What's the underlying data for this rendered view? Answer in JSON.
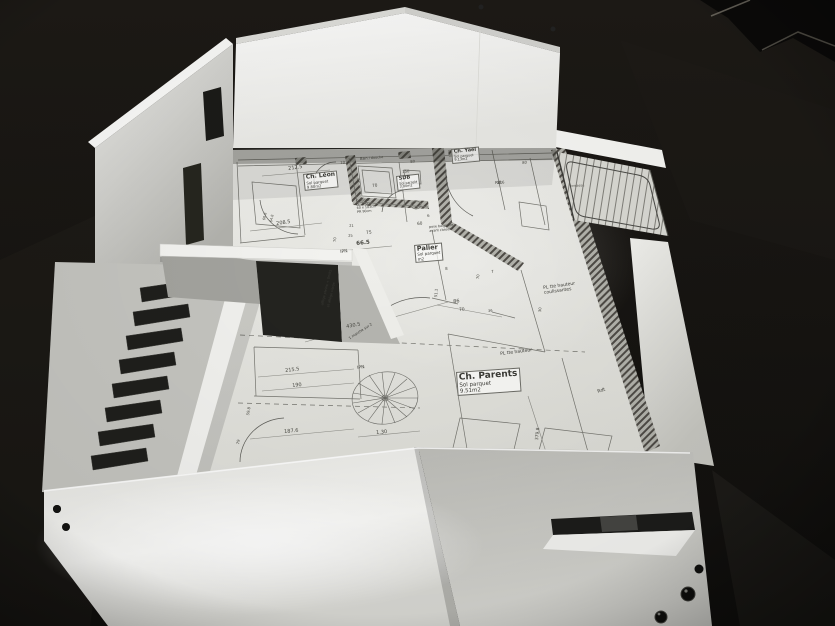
{
  "colors": {
    "table_background": "#16130f",
    "foam_white": "#f4f4f1",
    "plan_paper": "#ececе8",
    "drawing_ink": "#3a3a35",
    "hatch_wall": "#4e4b46",
    "shadow": "#23231f"
  },
  "plan": {
    "rooms": [
      {
        "name": "Ch. Léon",
        "floor": "Sol parquet",
        "area": "9.80m2"
      },
      {
        "name": "SDB",
        "floor": "Sol carrelé",
        "area": "3.80m2"
      },
      {
        "name": "Ch. Yael",
        "floor": "Sol parquet",
        "area": "9.13m2"
      },
      {
        "name": "Palier",
        "floor": "Sol parquet",
        "area": "m2"
      },
      {
        "name": "Ch. Parents",
        "floor": "Sol parquet",
        "area": "9.51m2"
      }
    ],
    "notes": {
      "bain": "Bain / douche",
      "colonne1": "Colonne",
      "colonne2": "LL + SL",
      "colonne3": "60 x 183cm",
      "colonne4": "PR 90cm",
      "pose1": "pose baignoire",
      "pose2": "avant cloison !",
      "ipn": "IPN",
      "rdt": "Rdt",
      "allege1": "allège pleine + 0m95",
      "allege2": "et allège vitrée",
      "marche": "1 marche sur 2",
      "pl_coulissantes1": "PL tte hauteur",
      "pl_coulissantes2": "coulissantes",
      "pl2": "PL tte hauteur",
      "terrasse": "terrasse"
    },
    "dims": [
      "212.5",
      "10",
      "80",
      "150",
      "70",
      "20",
      "80",
      "216",
      "208.5",
      "60.8",
      "64.8",
      "60",
      "6",
      "21",
      "25",
      "75",
      "70",
      "66.5",
      "8",
      "70",
      "7",
      "51.1",
      "86",
      "70",
      "30",
      "430.5",
      "215.5",
      "190",
      "59.8",
      "79",
      "187.6",
      "1.30",
      "379.8",
      "36"
    ]
  }
}
